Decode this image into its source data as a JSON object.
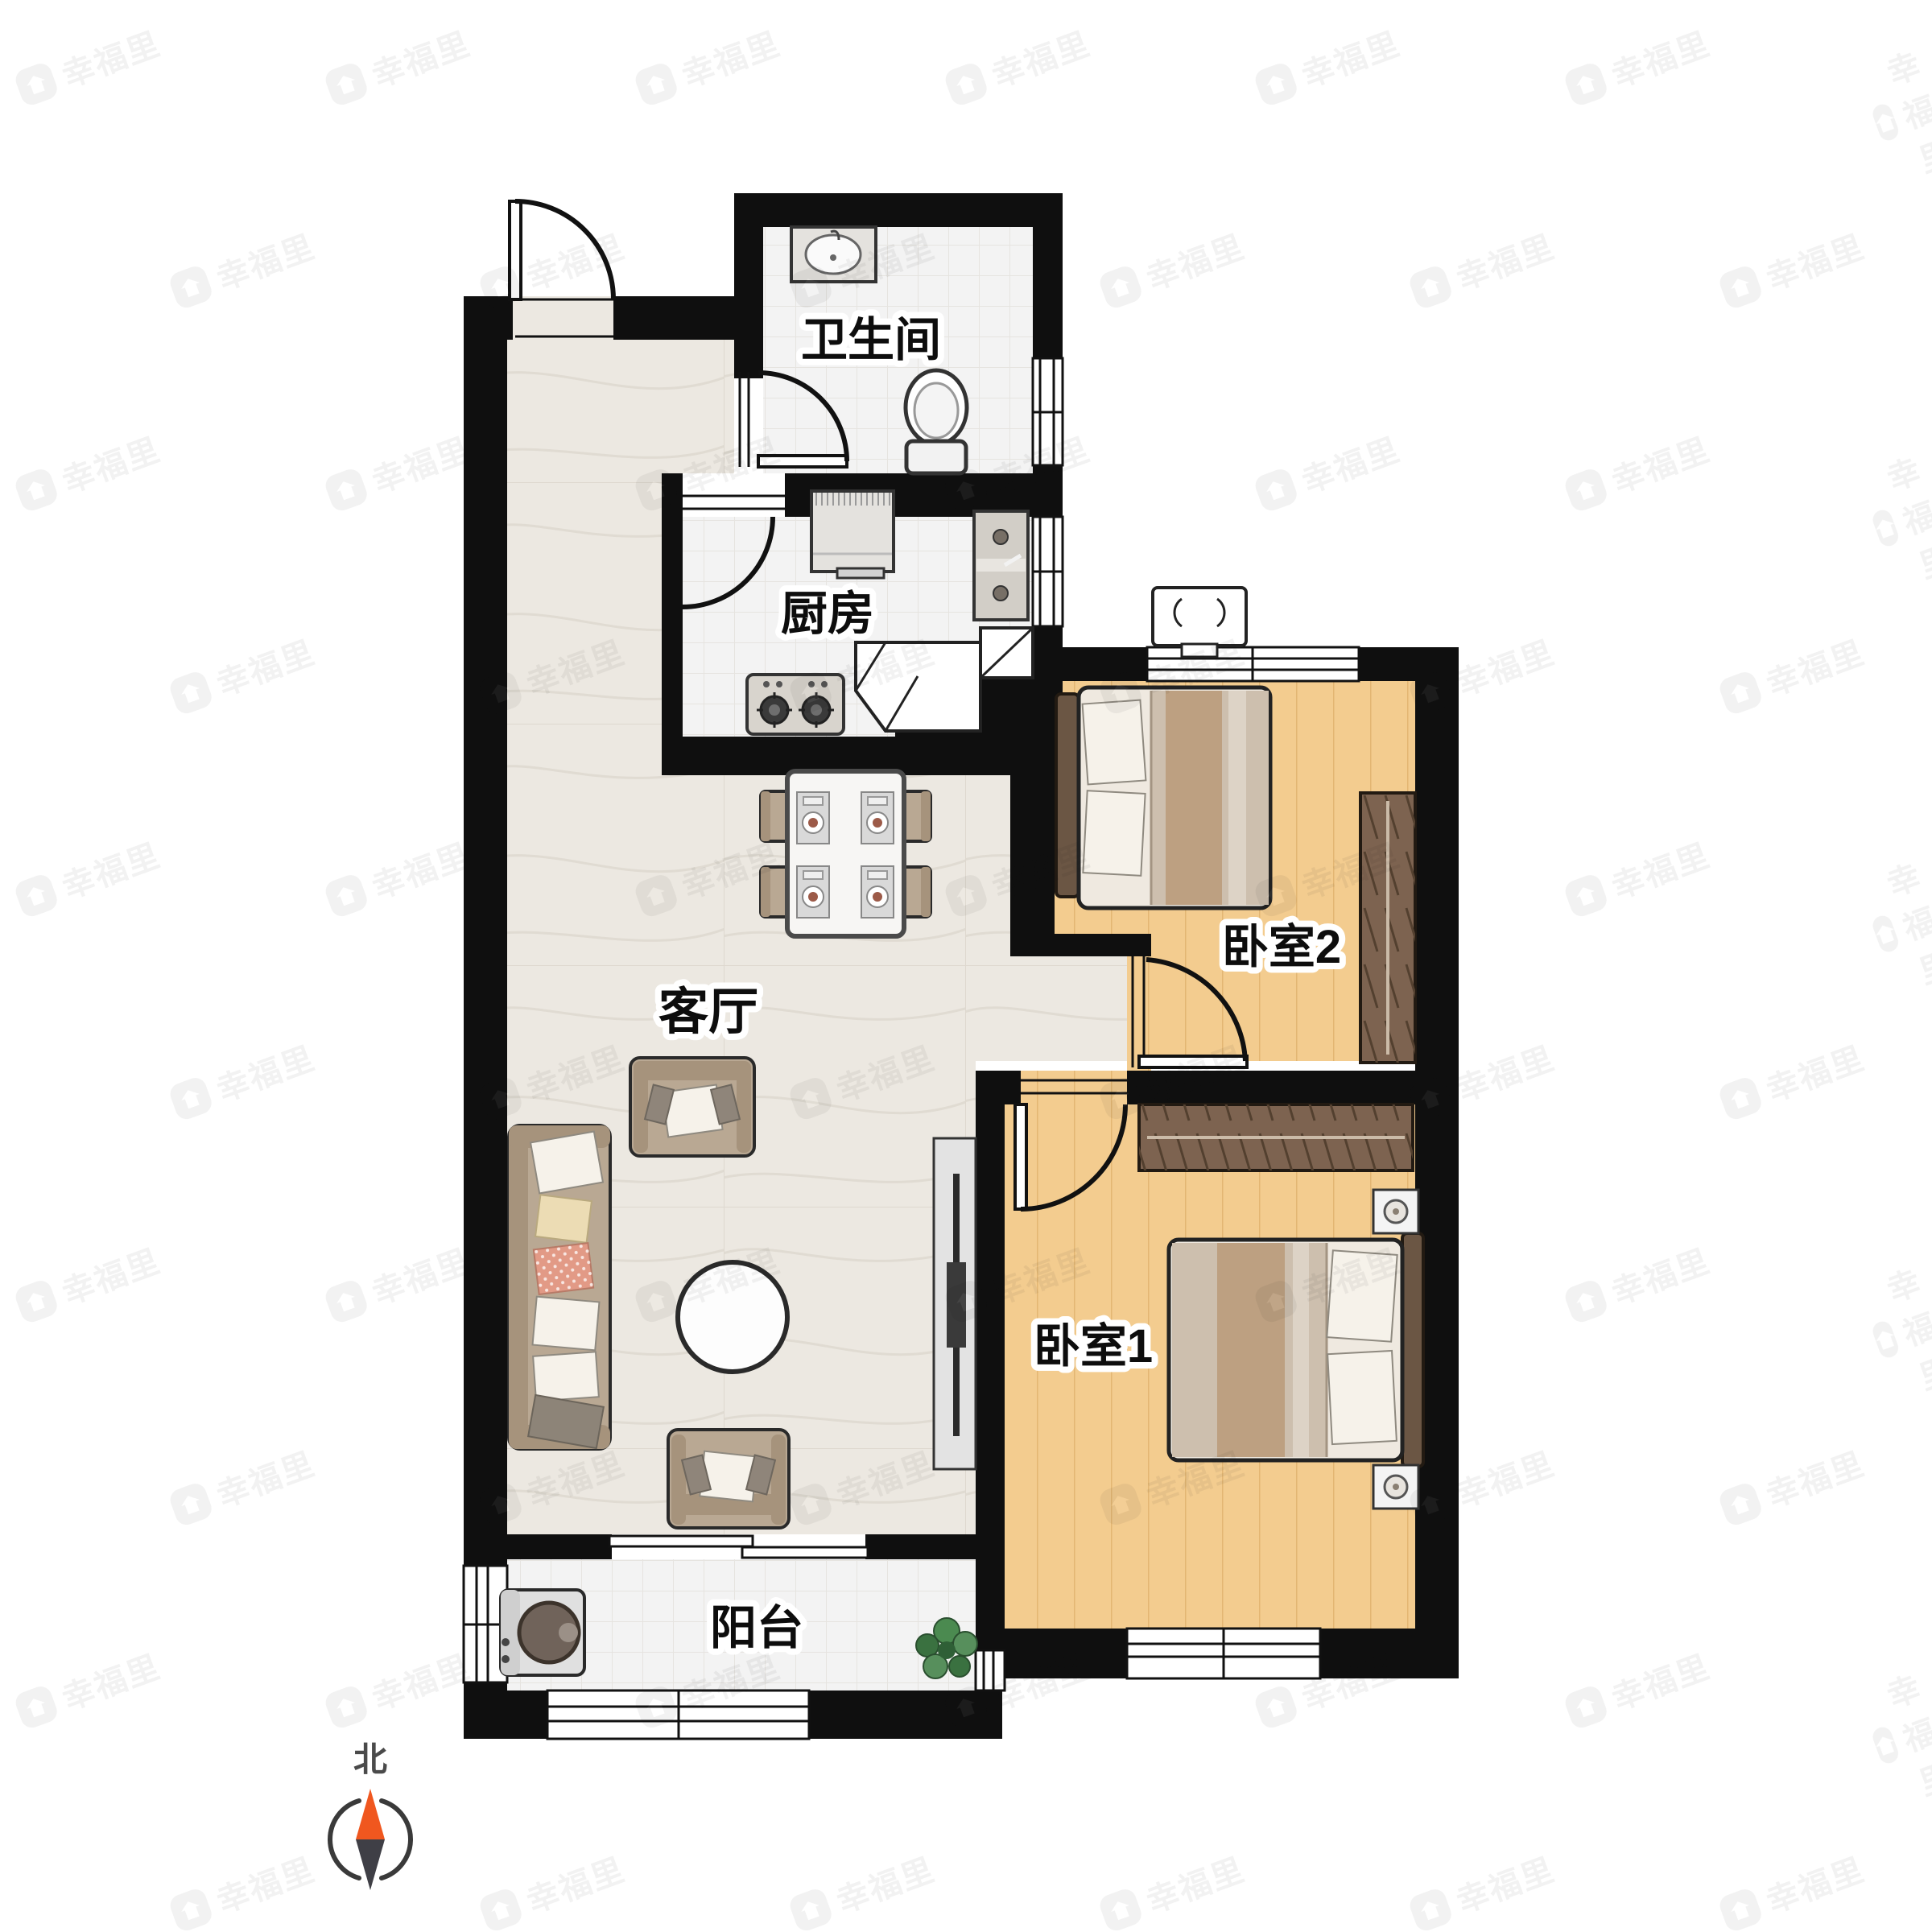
{
  "plan": {
    "rooms": [
      {
        "id": "bathroom",
        "label": "卫生间"
      },
      {
        "id": "kitchen",
        "label": "厨房"
      },
      {
        "id": "living",
        "label": "客厅"
      },
      {
        "id": "bedroom2",
        "label": "卧室2"
      },
      {
        "id": "bedroom1",
        "label": "卧室1"
      },
      {
        "id": "balcony",
        "label": "阳台"
      }
    ],
    "compass": {
      "label": "北"
    },
    "watermark": {
      "text": "幸福里"
    }
  },
  "colors": {
    "wall": "#0f0f0f",
    "marble": "#ece8e1",
    "tile": "#f3f3f3",
    "wood": "#f3cc8f",
    "woodline": "#e3b673",
    "fabric": "#b9a893",
    "fabricdk": "#a6937c",
    "wardrobe": "#7d6350",
    "headboard": "#6b5644",
    "blanket": "#cdbfae",
    "blanketstripe": "#bda081",
    "compassorange": "#f0571f",
    "compassdark": "#3f3f46"
  }
}
